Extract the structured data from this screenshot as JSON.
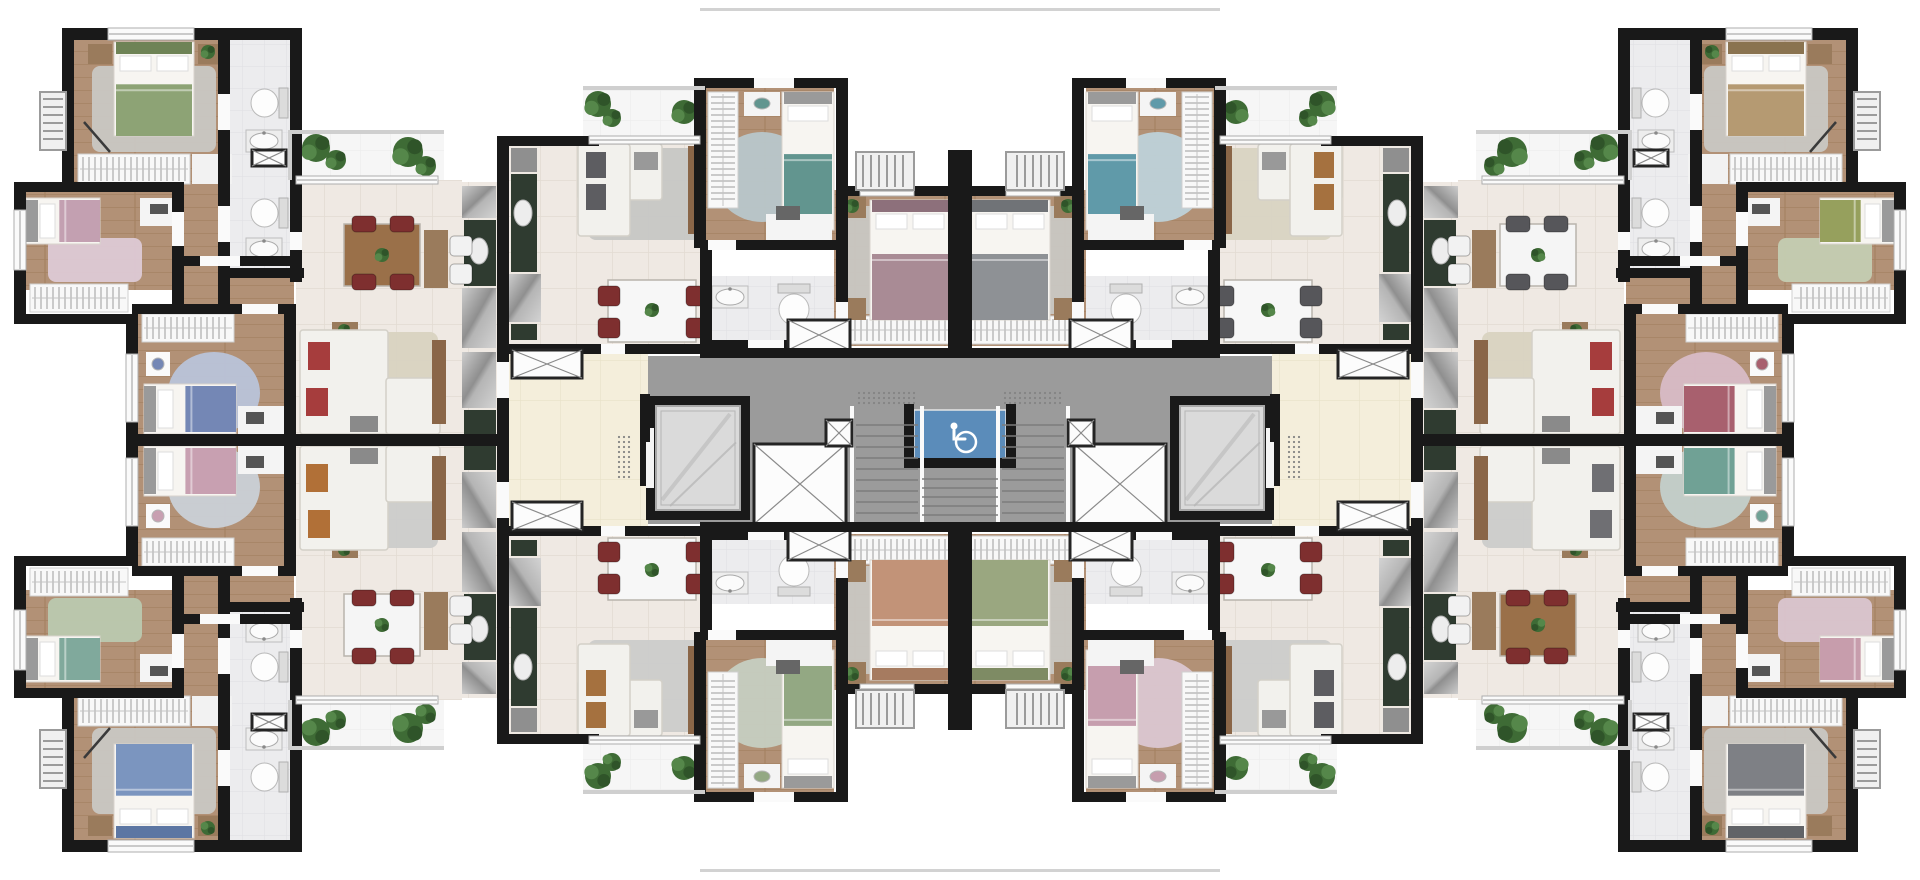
{
  "meta": {
    "kind": "architectural-floor-plan",
    "canvas_w": 1920,
    "canvas_h": 880,
    "description": "rendered top-view floor plan, 8 apartments mirrored in 4 quadrants around central core"
  },
  "palette": {
    "wall": "#191919",
    "core_gray": "#9b9b9b",
    "corridor_cream": "#f4eedb",
    "tile": "#efe9e3",
    "bath_tile": "#ececee",
    "wood": "#b29176",
    "balcony": "#f6f6f6",
    "counter_green": "#2f3b30",
    "accessible_blue": "#5b8cba",
    "rug_gray": "#c9c7c2",
    "white": "#fafafa"
  },
  "quadrants": {
    "tl": {
      "label": "unit-top-left",
      "colors": {
        "mb": "#8da375",
        "mp": "#6e8356",
        "sb": "#c3a0b1",
        "sr": "#ddc9d3",
        "db": "#7487b5",
        "dr": "#b9c3d7",
        "sp": "#a63d3d",
        "lr": "#d9d2c1",
        "dt": "#9a7049",
        "cs": "#7e2f2f",
        "cmb": "#a98b95",
        "cmt": "#8d707b",
        "csb": "#62958f",
        "csr": "#b8c6ca",
        "csp": "#5d5d61",
        "clr": "#c7c7c5"
      }
    },
    "tr": {
      "label": "unit-top-right",
      "colors": {
        "mb": "#b59a72",
        "mp": "#8a7350",
        "sb": "#96a05d",
        "sr": "#c4ccb1",
        "db": "#a8606e",
        "dr": "#d7bac5",
        "sp": "#a63d3d",
        "lr": "#d9d2c1",
        "dt": "#f5f5f5",
        "cs": "#56565a",
        "cmb": "#8e9195",
        "cmt": "#707377",
        "csb": "#609aa9",
        "csr": "#bdd0d7",
        "csp": "#a5713f",
        "clr": "#d9d3c3"
      }
    },
    "bl": {
      "label": "unit-bottom-left",
      "colors": {
        "mb": "#7b95bf",
        "mp": "#5c76a3",
        "sb": "#80a99c",
        "sr": "#bac8ae",
        "db": "#c8a0b1",
        "dr": "#cacfd5",
        "sp": "#b17037",
        "lr": "#cccccb",
        "dt": "#f5f5f5",
        "cs": "#7e2f2f",
        "cmb": "#c29378",
        "cmt": "#a67b60",
        "csb": "#93a883",
        "csr": "#c6cdc0",
        "csp": "#a5713f",
        "clr": "#cccccb"
      }
    },
    "br": {
      "label": "unit-bottom-right",
      "colors": {
        "mb": "#7e8085",
        "mp": "#616367",
        "sb": "#c79dac",
        "sr": "#dac5ce",
        "db": "#70a195",
        "dr": "#c3ceca",
        "sp": "#6f6f73",
        "lr": "#cccccb",
        "dt": "#9a7049",
        "cs": "#7e2f2f",
        "cmb": "#9aa780",
        "cmt": "#7e8b64",
        "csb": "#c69eae",
        "csr": "#dbc6cf",
        "csp": "#5d5d61",
        "clr": "#cccccb"
      }
    }
  },
  "quadrant_elements": [
    [
      "r",
      290,
      132,
      154,
      52,
      "@balcony"
    ],
    [
      "r",
      583,
      88,
      122,
      54,
      "@balcony"
    ],
    [
      "r",
      296,
      180,
      166,
      260,
      "@tile"
    ],
    [
      "r",
      462,
      182,
      36,
      252,
      "@tile"
    ],
    [
      "r",
      509,
      136,
      199,
      212,
      "@tile"
    ],
    [
      "r",
      509,
      348,
      139,
      92,
      "@cream"
    ],
    [
      "r",
      70,
      36,
      166,
      154,
      "@wood"
    ],
    [
      "r",
      20,
      188,
      160,
      102,
      "@wood"
    ],
    [
      "r",
      182,
      190,
      112,
      122,
      "@wood"
    ],
    [
      "r",
      134,
      310,
      160,
      130,
      "@wood"
    ],
    [
      "r",
      702,
      86,
      132,
      160,
      "@wood"
    ],
    [
      "r",
      834,
      190,
      124,
      156,
      "@wood"
    ],
    [
      "r",
      228,
      36,
      66,
      236,
      "@bath"
    ],
    [
      "r",
      706,
      276,
      128,
      70,
      "@bath"
    ],
    [
      "rugR",
      92,
      66,
      124,
      86,
      "%rug_gray"
    ],
    [
      "rugR",
      48,
      238,
      94,
      44,
      "$sr"
    ],
    [
      "rugE",
      168,
      352,
      92,
      82,
      "$dr"
    ],
    [
      "rugE",
      714,
      132,
      96,
      90,
      "$csr"
    ],
    [
      "rugR",
      330,
      332,
      108,
      102,
      "$lr"
    ],
    [
      "rugR",
      588,
      148,
      118,
      92,
      "$clr"
    ],
    [
      "rugR",
      842,
      206,
      104,
      108,
      "%rug_gray"
    ],
    [
      "hH",
      78,
      154,
      112,
      30
    ],
    [
      "r",
      192,
      154,
      40,
      30,
      "#f2f2f2"
    ],
    [
      "hH",
      30,
      284,
      98,
      28
    ],
    [
      "hH",
      142,
      314,
      92,
      28
    ],
    [
      "hV",
      708,
      92,
      30,
      116
    ],
    [
      "hH",
      838,
      316,
      114,
      28
    ],
    [
      "r",
      462,
      186,
      34,
      32,
      "@steel"
    ],
    [
      "r",
      464,
      220,
      32,
      66,
      "%counter_green"
    ],
    [
      "e",
      470,
      238,
      18,
      26,
      "#ededed"
    ],
    [
      "r",
      462,
      288,
      34,
      60,
      "@steel"
    ],
    [
      "r",
      462,
      352,
      34,
      56,
      "@steel"
    ],
    [
      "r",
      464,
      410,
      32,
      24,
      "%counter_green"
    ],
    [
      "r",
      511,
      148,
      26,
      24,
      "#8f8f8f"
    ],
    [
      "r",
      511,
      174,
      26,
      98,
      "%counter_green"
    ],
    [
      "e",
      514,
      200,
      18,
      26,
      "#ededed"
    ],
    [
      "r",
      509,
      274,
      32,
      48,
      "@steel"
    ],
    [
      "r",
      511,
      324,
      26,
      16,
      "%counter_green"
    ],
    [
      "bedV",
      114,
      42,
      80,
      94,
      "$mb",
      "$mp"
    ],
    [
      "bedH",
      26,
      198,
      74,
      46,
      "$sb",
      "#9a9a9a"
    ],
    [
      "bedH",
      144,
      384,
      92,
      50,
      "$db",
      "#9a9a9a"
    ],
    [
      "bedV",
      782,
      92,
      52,
      138,
      "$csb",
      "#9a9a9a"
    ],
    [
      "bedV",
      870,
      200,
      80,
      120,
      "$cmb",
      "$cmt"
    ],
    [
      "r",
      88,
      44,
      24,
      20,
      "#9a7b5c"
    ],
    [
      "r",
      198,
      44,
      24,
      20,
      "#9a7b5c"
    ],
    [
      "plant",
      208,
      52,
      7
    ],
    [
      "r",
      140,
      198,
      38,
      28,
      "#f4f4f4"
    ],
    [
      "r",
      150,
      204,
      18,
      10,
      "#555555"
    ],
    [
      "r",
      238,
      406,
      52,
      30,
      "#f4f4f4"
    ],
    [
      "r",
      246,
      412,
      18,
      12,
      "#555555"
    ],
    [
      "r",
      146,
      352,
      24,
      24,
      "#fafafa"
    ],
    [
      "e",
      152,
      358,
      12,
      12,
      "$db"
    ],
    [
      "r",
      744,
      92,
      36,
      24,
      "#f4f4f4"
    ],
    [
      "e",
      754,
      98,
      16,
      11,
      "$csb"
    ],
    [
      "r",
      766,
      214,
      66,
      28,
      "#f4f4f4"
    ],
    [
      "r",
      776,
      206,
      24,
      14,
      "#666666"
    ],
    [
      "r",
      838,
      196,
      28,
      22,
      "#9a7b5c"
    ],
    [
      "plant",
      852,
      206,
      7
    ],
    [
      "r",
      838,
      298,
      28,
      22,
      "#9a7b5c"
    ],
    [
      "r",
      332,
      322,
      26,
      18,
      "#9a7b5c"
    ],
    [
      "plant",
      344,
      330,
      6
    ],
    [
      "line",
      84,
      122,
      110,
      152
    ],
    [
      "s",
      300,
      330,
      88,
      104
    ],
    [
      "s",
      386,
      378,
      54,
      56
    ],
    [
      "r",
      308,
      342,
      22,
      28,
      "$sp"
    ],
    [
      "r",
      306,
      388,
      22,
      28,
      "$sp"
    ],
    [
      "r",
      350,
      416,
      28,
      16,
      "#8a8a8a"
    ],
    [
      "r",
      432,
      340,
      14,
      84,
      "#8a6648"
    ],
    [
      "s",
      578,
      144,
      84,
      56
    ],
    [
      "s",
      578,
      144,
      52,
      92
    ],
    [
      "r",
      586,
      152,
      20,
      26,
      "$csp"
    ],
    [
      "r",
      586,
      184,
      20,
      26,
      "$csp"
    ],
    [
      "r",
      634,
      152,
      24,
      18,
      "#999999"
    ],
    [
      "r",
      688,
      146,
      16,
      88,
      "#8a6648"
    ],
    [
      "tbl",
      344,
      224,
      76,
      62,
      "$dt"
    ],
    [
      "chair",
      352,
      216,
      24,
      16,
      "$cs"
    ],
    [
      "chair",
      390,
      216,
      24,
      16,
      "$cs"
    ],
    [
      "chair",
      352,
      274,
      24,
      16,
      "$cs"
    ],
    [
      "chair",
      390,
      274,
      24,
      16,
      "$cs"
    ],
    [
      "plant",
      382,
      255,
      7
    ],
    [
      "r",
      424,
      230,
      24,
      58,
      "#9a7b5c"
    ],
    [
      "chair",
      450,
      236,
      22,
      20,
      "#f2f2f2"
    ],
    [
      "chair",
      450,
      264,
      22,
      20,
      "#f2f2f2"
    ],
    [
      "tbl",
      608,
      280,
      88,
      62,
      "#f7f7f7"
    ],
    [
      "chair",
      598,
      286,
      22,
      20,
      "$cs"
    ],
    [
      "chair",
      598,
      318,
      22,
      20,
      "$cs"
    ],
    [
      "chair",
      686,
      286,
      22,
      20,
      "$cs"
    ],
    [
      "chair",
      686,
      318,
      22,
      20,
      "$cs"
    ],
    [
      "plant",
      652,
      310,
      7
    ],
    [
      "toiL",
      250,
      88,
      38,
      30
    ],
    [
      "sink",
      246,
      130,
      36,
      22
    ],
    [
      "toiL",
      250,
      198,
      38,
      30
    ],
    [
      "sink",
      246,
      238,
      36,
      22
    ],
    [
      "xb",
      252,
      150,
      34,
      16
    ],
    [
      "sink",
      712,
      286,
      36,
      22
    ],
    [
      "toiD",
      778,
      284,
      32,
      42
    ],
    [
      "plant",
      316,
      148,
      14
    ],
    [
      "plant",
      336,
      160,
      10
    ],
    [
      "plant",
      408,
      152,
      15
    ],
    [
      "plant",
      426,
      166,
      10
    ],
    [
      "plant",
      598,
      104,
      13
    ],
    [
      "plant",
      612,
      118,
      9
    ],
    [
      "plant",
      684,
      112,
      12
    ],
    [
      "w",
      62,
      28,
      240,
      12
    ],
    [
      "w",
      62,
      28,
      12,
      162
    ],
    [
      "w",
      14,
      182,
      170,
      10
    ],
    [
      "w",
      14,
      182,
      12,
      142
    ],
    [
      "w",
      14,
      314,
      122,
      10
    ],
    [
      "w",
      126,
      314,
      12,
      40
    ],
    [
      "w",
      126,
      422,
      12,
      24
    ],
    [
      "w",
      132,
      304,
      110,
      10
    ],
    [
      "w",
      278,
      304,
      18,
      10
    ],
    [
      "w",
      284,
      304,
      12,
      136
    ],
    [
      "w",
      172,
      190,
      12,
      22
    ],
    [
      "w",
      172,
      246,
      12,
      68
    ],
    [
      "w",
      218,
      36,
      12,
      58
    ],
    [
      "w",
      218,
      130,
      12,
      76
    ],
    [
      "w",
      218,
      242,
      12,
      72
    ],
    [
      "w",
      290,
      36,
      12,
      196
    ],
    [
      "w",
      290,
      250,
      12,
      32
    ],
    [
      "w",
      228,
      268,
      76,
      10
    ],
    [
      "w",
      184,
      256,
      16,
      10
    ],
    [
      "w",
      240,
      256,
      56,
      10
    ],
    [
      "w",
      497,
      136,
      12,
      226
    ],
    [
      "w",
      497,
      398,
      12,
      42
    ],
    [
      "w",
      128,
      434,
      381,
      6
    ],
    [
      "w",
      497,
      136,
      102,
      10
    ],
    [
      "w",
      694,
      78,
      60,
      10
    ],
    [
      "w",
      794,
      78,
      52,
      10
    ],
    [
      "w",
      694,
      82,
      12,
      166
    ],
    [
      "w",
      836,
      78,
      12,
      120
    ],
    [
      "w",
      736,
      240,
      110,
      10
    ],
    [
      "w",
      700,
      240,
      8,
      10
    ],
    [
      "w",
      836,
      186,
      124,
      10
    ],
    [
      "w",
      948,
      150,
      12,
      200
    ],
    [
      "w",
      836,
      196,
      12,
      106
    ],
    [
      "w",
      836,
      338,
      12,
      12
    ],
    [
      "w",
      700,
      246,
      12,
      98
    ],
    [
      "w",
      700,
      340,
      48,
      10
    ],
    [
      "w",
      784,
      340,
      62,
      10
    ],
    [
      "w",
      509,
      344,
      92,
      10
    ],
    [
      "w",
      625,
      344,
      81,
      10
    ],
    [
      "w",
      640,
      394,
      10,
      48
    ],
    [
      "r",
      172,
      212,
      12,
      34,
      "%white"
    ],
    [
      "r",
      218,
      94,
      12,
      36,
      "%white"
    ],
    [
      "r",
      218,
      206,
      12,
      36,
      "%white"
    ],
    [
      "r",
      242,
      304,
      36,
      10,
      "%white"
    ],
    [
      "r",
      200,
      256,
      40,
      10,
      "%white"
    ],
    [
      "r",
      290,
      232,
      12,
      18,
      "%white"
    ],
    [
      "r",
      497,
      362,
      12,
      36,
      "%white"
    ],
    [
      "r",
      754,
      78,
      40,
      10,
      "%white"
    ],
    [
      "r",
      836,
      302,
      12,
      36,
      "%white"
    ],
    [
      "r",
      748,
      340,
      36,
      10,
      "%white"
    ],
    [
      "r",
      601,
      344,
      24,
      10,
      "%white"
    ],
    [
      "r",
      708,
      240,
      28,
      10,
      "%white"
    ],
    [
      "win",
      108,
      28,
      86,
      12
    ],
    [
      "win",
      14,
      210,
      12,
      60
    ],
    [
      "win",
      126,
      354,
      12,
      68
    ],
    [
      "win",
      296,
      176,
      142,
      8
    ],
    [
      "win",
      589,
      136,
      111,
      8
    ],
    [
      "win",
      860,
      186,
      54,
      10
    ],
    [
      "rail2",
      288,
      130,
      156,
      4
    ],
    [
      "rail2",
      288,
      130,
      4,
      50
    ],
    [
      "rail2",
      583,
      86,
      122,
      4
    ],
    [
      "lV",
      40,
      92,
      26,
      58
    ],
    [
      "lH",
      856,
      152,
      58,
      38
    ],
    [
      "xb",
      512,
      350,
      70,
      28
    ],
    [
      "xb",
      788,
      320,
      62,
      30
    ]
  ],
  "core_elements": [
    [
      "r",
      648,
      356,
      624,
      168,
      "%core_gray"
    ],
    [
      "dots",
      856,
      390,
      62,
      16
    ],
    [
      "dots",
      1002,
      390,
      62,
      16
    ],
    [
      "dots",
      616,
      434,
      18,
      46
    ],
    [
      "dots",
      1286,
      434,
      18,
      46
    ],
    [
      "wc",
      914,
      410,
      92,
      50
    ],
    [
      "w",
      904,
      404,
      10,
      62
    ],
    [
      "w",
      1006,
      404,
      10,
      62
    ],
    [
      "w",
      904,
      458,
      112,
      10
    ],
    [
      "rail",
      850,
      406,
      4,
      120
    ],
    [
      "rail",
      920,
      406,
      4,
      120
    ],
    [
      "rail",
      996,
      406,
      4,
      120
    ],
    [
      "rail",
      1066,
      406,
      4,
      120
    ],
    [
      "stairs",
      856,
      414,
      62,
      110,
      9
    ],
    [
      "stairs",
      1002,
      414,
      62,
      110,
      9
    ],
    [
      "stairs",
      922,
      470,
      76,
      54,
      5
    ],
    [
      "w",
      646,
      396,
      104,
      124
    ],
    [
      "marble",
      656,
      406,
      84,
      104
    ],
    [
      "r",
      646,
      428,
      8,
      60,
      "#f4f4f4"
    ],
    [
      "w",
      1170,
      396,
      104,
      124
    ],
    [
      "marble",
      1180,
      406,
      84,
      104
    ],
    [
      "r",
      1266,
      428,
      8,
      60,
      "#f4f4f4"
    ],
    [
      "xb",
      754,
      444,
      92,
      80
    ],
    [
      "xb",
      1074,
      444,
      92,
      80
    ],
    [
      "xb",
      826,
      420,
      26,
      26
    ],
    [
      "xb",
      1068,
      420,
      26,
      26
    ],
    [
      "w",
      700,
      348,
      520,
      10
    ],
    [
      "w",
      700,
      522,
      520,
      10
    ],
    [
      "w",
      640,
      394,
      10,
      48
    ],
    [
      "w",
      1270,
      394,
      10,
      48
    ],
    [
      "r",
      700,
      8,
      520,
      3,
      "#d2d2d2"
    ],
    [
      "r",
      700,
      869,
      520,
      3,
      "#d2d2d2"
    ]
  ]
}
